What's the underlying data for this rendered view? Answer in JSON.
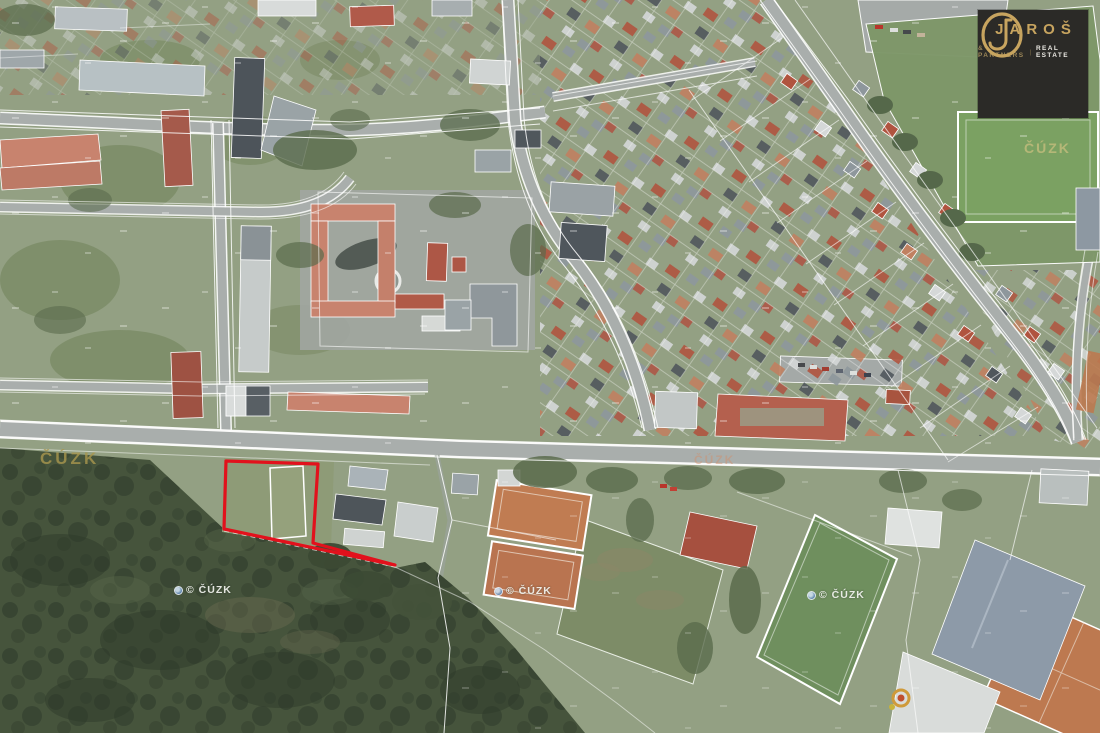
{
  "page": {
    "kind": "aerial-cadastral-map",
    "description": "Satellite orthophoto with white cadastral parcel boundaries, a red-highlighted parcel for sale near a forest edge, sports fields and housing estates"
  },
  "branding": {
    "name": "JAROŠ",
    "monogram_letters": "JD",
    "tagline_left": "& PARTNERS",
    "tagline_sep": "|",
    "tagline_right": "REAL ESTATE",
    "plate_color": "#2b2a27",
    "gold_color": "#c7a45f"
  },
  "watermarks": {
    "cuzk_gold": "ČÚZK",
    "cuzk_field": "ČÚZK",
    "cuzk_road": "ČÚZK",
    "copyright": "© ČÚZK"
  },
  "highlight": {
    "color": "#e2111c",
    "meaning": "boundary of advertised parcel"
  },
  "map_colors": {
    "cadastral_line": "#ffffff",
    "forest": "#46543c",
    "field_green": "#6f8f5e",
    "clay_court": "#c07c52",
    "road": "#a9aeac"
  }
}
